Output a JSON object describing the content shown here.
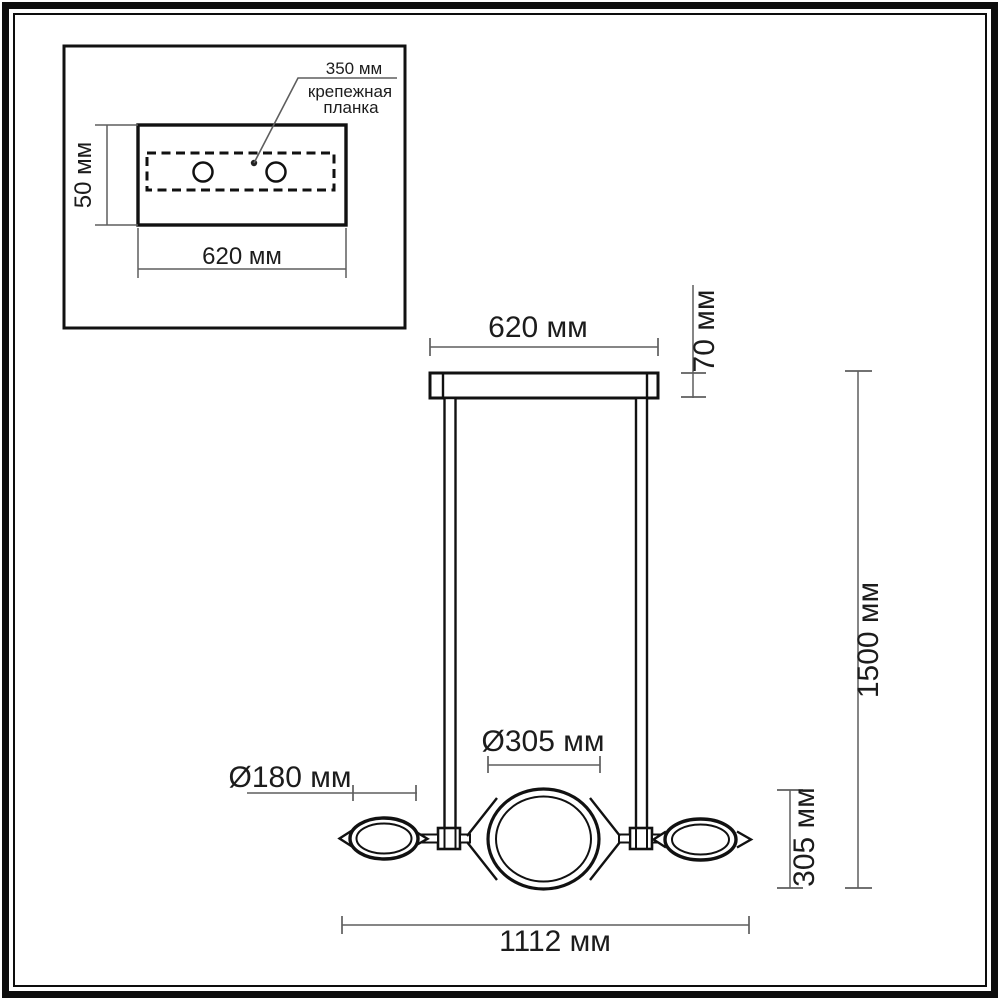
{
  "inset": {
    "bracket_length": "350 мм",
    "bracket_name_line1": "крепежная",
    "bracket_name_line2": "планка",
    "plate_height": "50 мм",
    "plate_length": "620 мм"
  },
  "drawing": {
    "canopy_length": "620 мм",
    "canopy_height": "70 мм",
    "overall_height": "1500 мм",
    "center_shade_diameter": "Ø305 мм",
    "side_shade_diameter": "Ø180 мм",
    "center_shade_height": "305 мм",
    "overall_length": "1112 мм"
  },
  "colors": {
    "outline": "#111111",
    "dimension_line": "#5e5e5e",
    "text": "#1c1c1c",
    "background": "#ffffff"
  }
}
